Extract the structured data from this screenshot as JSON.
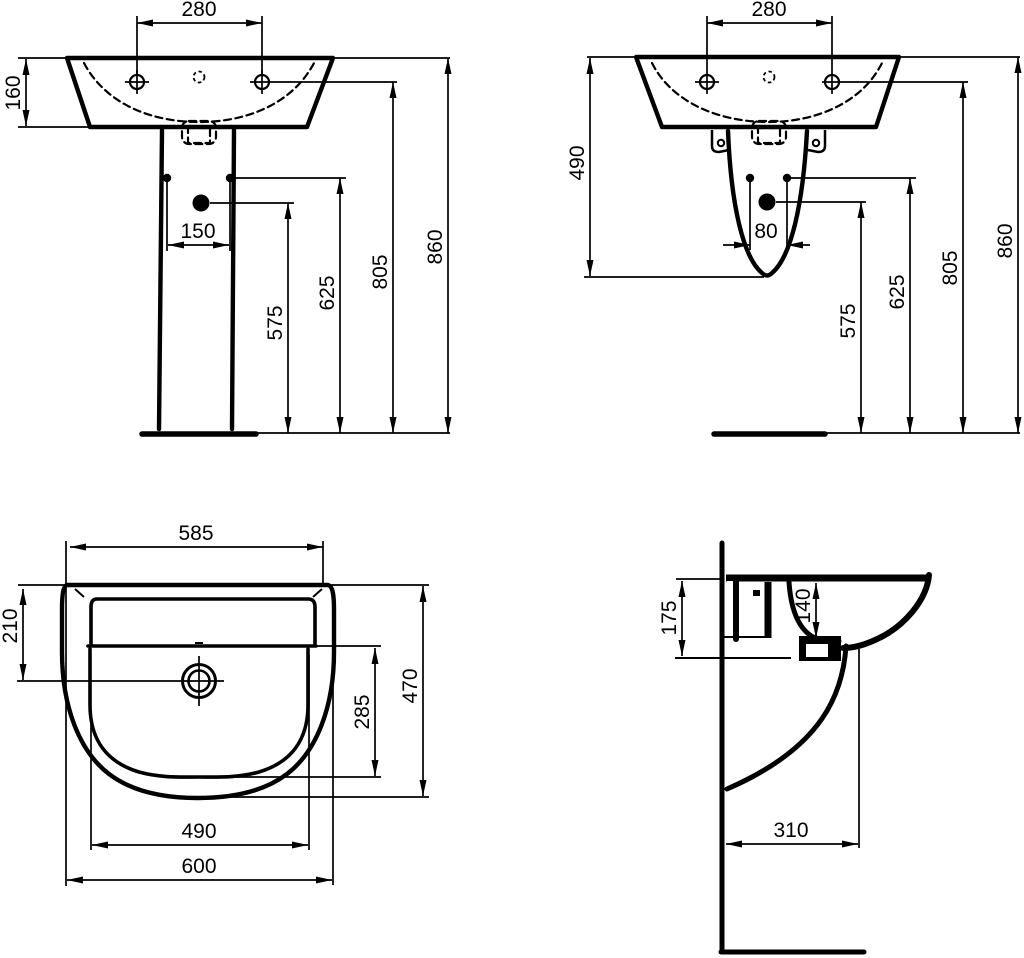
{
  "drawing": {
    "type": "sanitaryware dimensional drawing",
    "ink_color": "#000000",
    "background_color": "#ffffff"
  },
  "views": {
    "front_pedestal": {
      "name": "front view with full pedestal",
      "dims": {
        "tap_spacing": "280",
        "rim_height": "160",
        "fixing_width": "150",
        "h_outlet": "575",
        "h_fixings": "625",
        "h_taps": "805",
        "h_rim": "860"
      }
    },
    "front_semi": {
      "name": "front view with semi-pedestal",
      "dims": {
        "tap_spacing": "280",
        "semi_height": "490",
        "fixing_spacing": "80",
        "h_outlet": "575",
        "h_fixings": "625",
        "h_taps": "805",
        "h_rim": "860"
      }
    },
    "plan": {
      "name": "plan view",
      "dims": {
        "rim_width": "585",
        "outlet_setback": "210",
        "bowl_length": "285",
        "overall_depth": "470",
        "bowl_width": "490",
        "overall_width": "600"
      }
    },
    "side": {
      "name": "side view",
      "dims": {
        "wall_fixing_height": "175",
        "bowl_depth": "140",
        "projection": "310"
      }
    }
  }
}
